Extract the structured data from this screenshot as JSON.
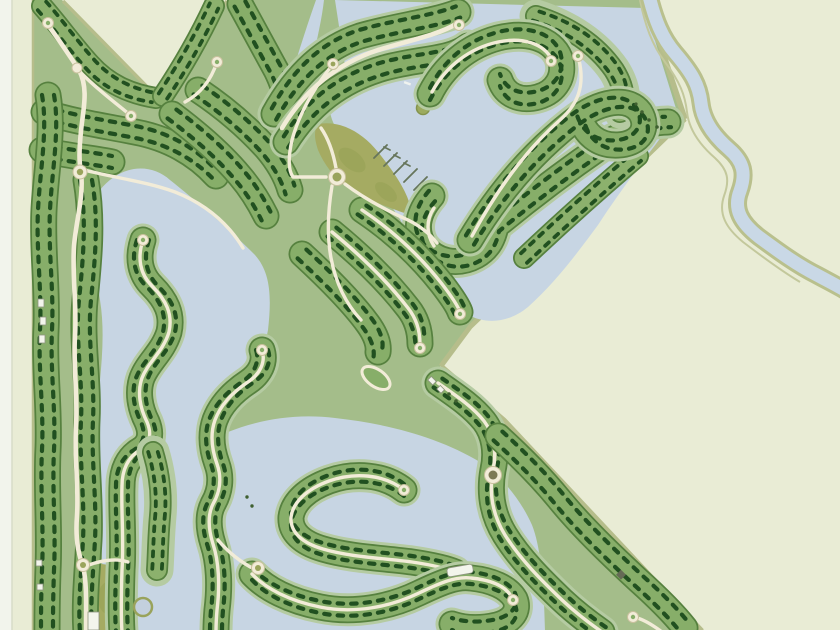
{
  "map": {
    "type": "masterplan-site-map",
    "title": "Lakeside residential community masterplan",
    "aria_label": "Aerial masterplan map of a gated lakeside residential community with tree-lined lot strips, lagoons, winding roads, cul-de-sacs, parks and a river along the north-east boundary",
    "visible_text": [],
    "features": {
      "lot_strips": 30,
      "lagoons": 4,
      "small_ponds": 2,
      "parks": 2,
      "cul_de_sacs": 13,
      "roundabouts": 6,
      "boat_piers": 5,
      "islands": 1,
      "river": 1,
      "buildings": 6
    },
    "palette": {
      "background": "#e9ecd5",
      "page_margin": "#f2f4ec",
      "water": "#c7d5e3",
      "strip_green": "#87ae69",
      "strip_outline": "#56813f",
      "shore_halo": "#b5cba2",
      "lot_marks_dark_green": "#215020",
      "road_cream": "#f2ecd8",
      "park_olive": "#a5ab62",
      "river_bank_olive": "#b9c08d",
      "base_green": "#a4bd8a"
    }
  }
}
